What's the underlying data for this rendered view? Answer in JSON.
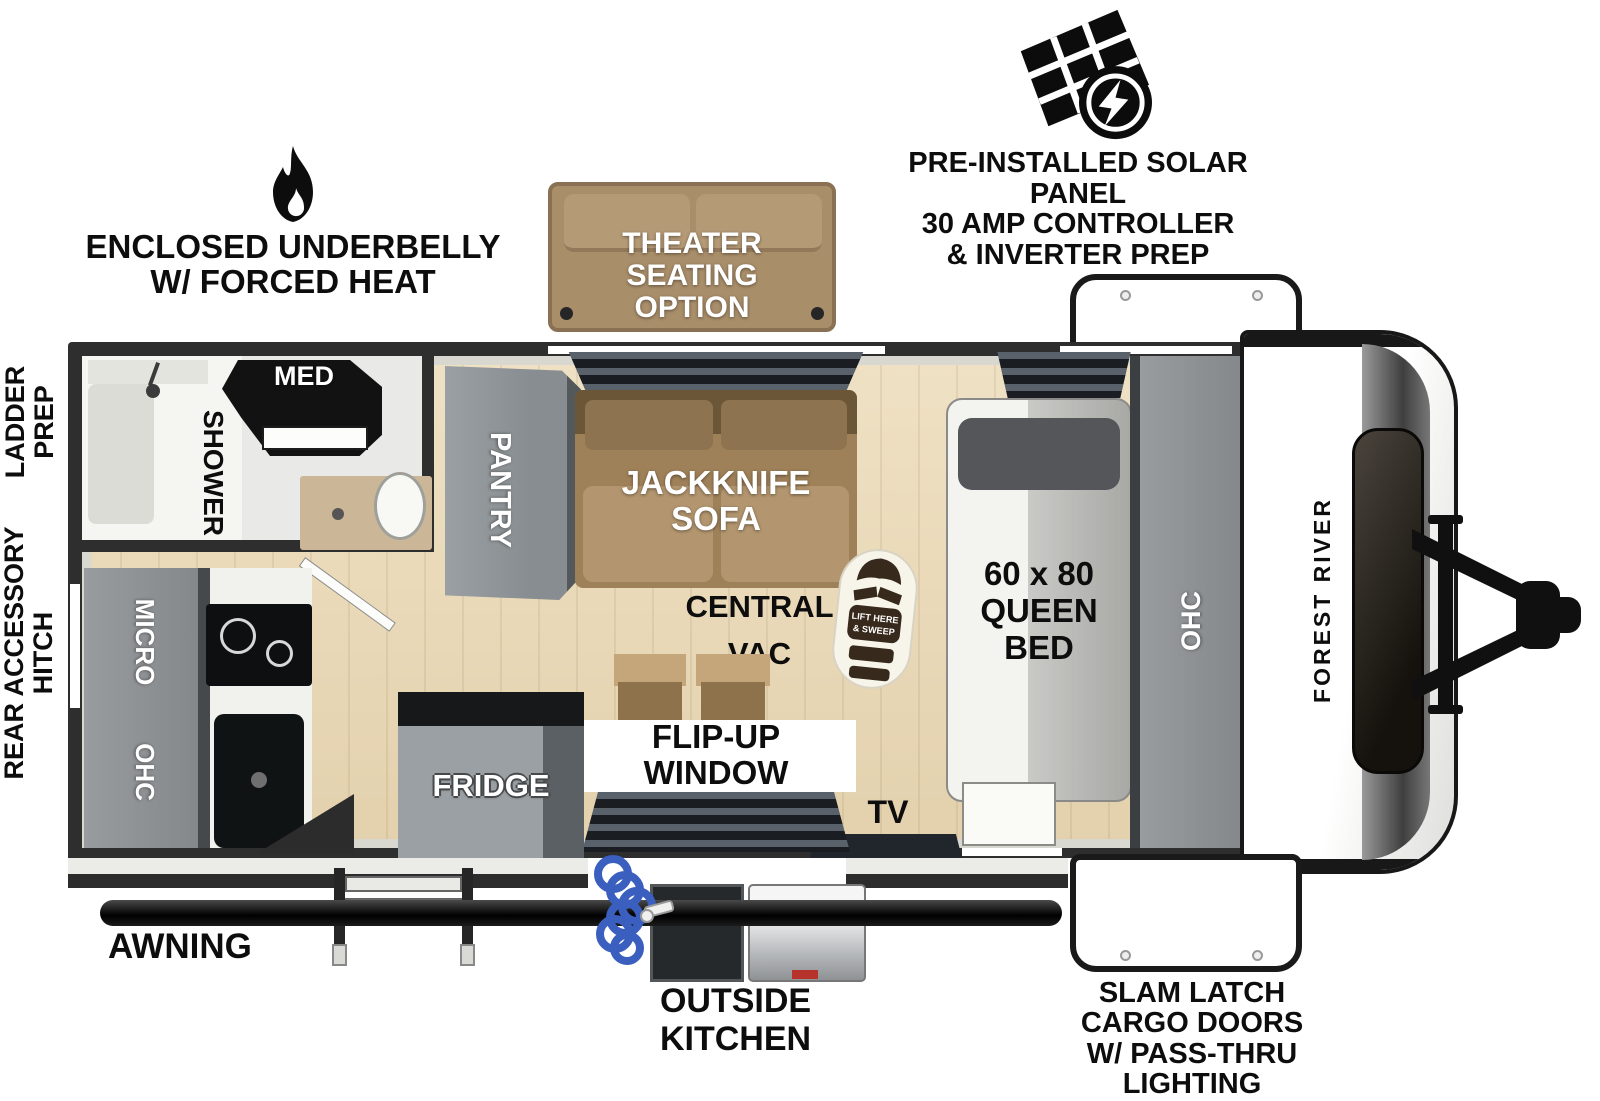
{
  "brand": {
    "name": "FOREST RIVER"
  },
  "features": {
    "solar": {
      "lines": [
        "PRE-INSTALLED SOLAR PANEL",
        "30 AMP CONTROLLER",
        "& INVERTER PREP"
      ]
    },
    "underbelly": {
      "lines": [
        "ENCLOSED UNDERBELLY",
        "W/ FORCED HEAT"
      ]
    },
    "theater_seating": {
      "lines": [
        "THEATER",
        "SEATING",
        "OPTION"
      ]
    },
    "ladder_prep": {
      "lines": [
        "LADDER",
        "PREP"
      ]
    },
    "rear_accessory_hitch": {
      "lines": [
        "REAR ACCESSORY",
        "HITCH"
      ]
    },
    "awning": {
      "label": "AWNING"
    },
    "outside_kitchen": {
      "lines": [
        "OUTSIDE",
        "KITCHEN"
      ]
    },
    "slam_latch": {
      "lines": [
        "SLAM LATCH",
        "CARGO DOORS",
        "W/ PASS-THRU",
        "LIGHTING"
      ]
    }
  },
  "rooms": {
    "shower": {
      "label": "SHOWER"
    },
    "med_cabinet": {
      "label": "MED"
    },
    "pantry": {
      "label": "PANTRY"
    },
    "jackknife_sofa": {
      "lines": [
        "JACKKNIFE",
        "SOFA"
      ]
    },
    "central_vac": {
      "lines": [
        "CENTRAL",
        "VAC"
      ]
    },
    "vac_pan": {
      "lines": [
        "LIFT HERE",
        "& SWEEP"
      ]
    },
    "queen_bed": {
      "lines": [
        "60 x 80",
        "QUEEN",
        "BED"
      ]
    },
    "bed_overhead_cabinet": {
      "label": "OHC"
    },
    "microwave": {
      "label": "MICRO"
    },
    "kitchen_overhead_cabinet": {
      "label": "OHC"
    },
    "fridge": {
      "label": "FRIDGE"
    },
    "flip_up_window": {
      "lines": [
        "FLIP-UP",
        "WINDOW"
      ]
    },
    "tv": {
      "label": "TV"
    }
  },
  "colors": {
    "wall": "#2e2e2e",
    "floor_wood": "#e9dabb",
    "cabinet_gray": "#8e9296",
    "sofa_brown": "#9f8159",
    "theater_brown": "#a98e6a",
    "hose_blue": "#3a5fbe"
  }
}
